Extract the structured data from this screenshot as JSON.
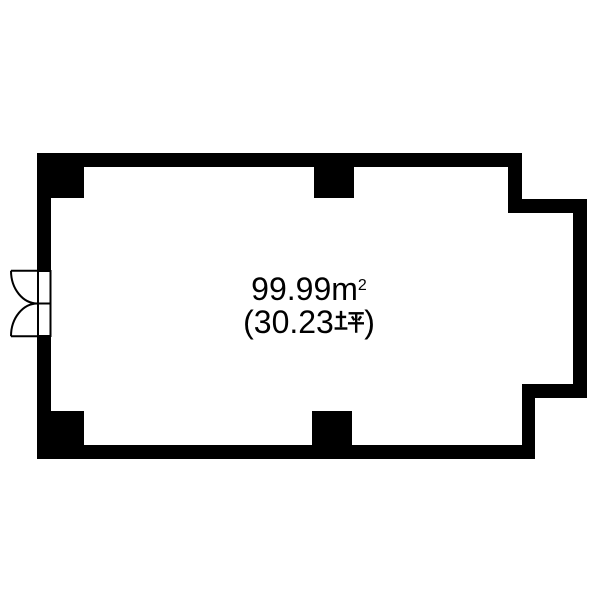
{
  "page": {
    "background_color": "#ffffff"
  },
  "floorplan": {
    "wall_color": "#000000",
    "interior_color": "#ffffff",
    "door_symbol": "double-swing-door-icon",
    "area_label": {
      "line1": "99.99㎡",
      "line2": "(30.23坪)",
      "line1_value": "99.99",
      "line1_unit_base": "m",
      "line1_unit_sup": "2",
      "line2_prefix": "(30.23",
      "line2_unit": "坪",
      "line2_suffix": ")"
    }
  }
}
